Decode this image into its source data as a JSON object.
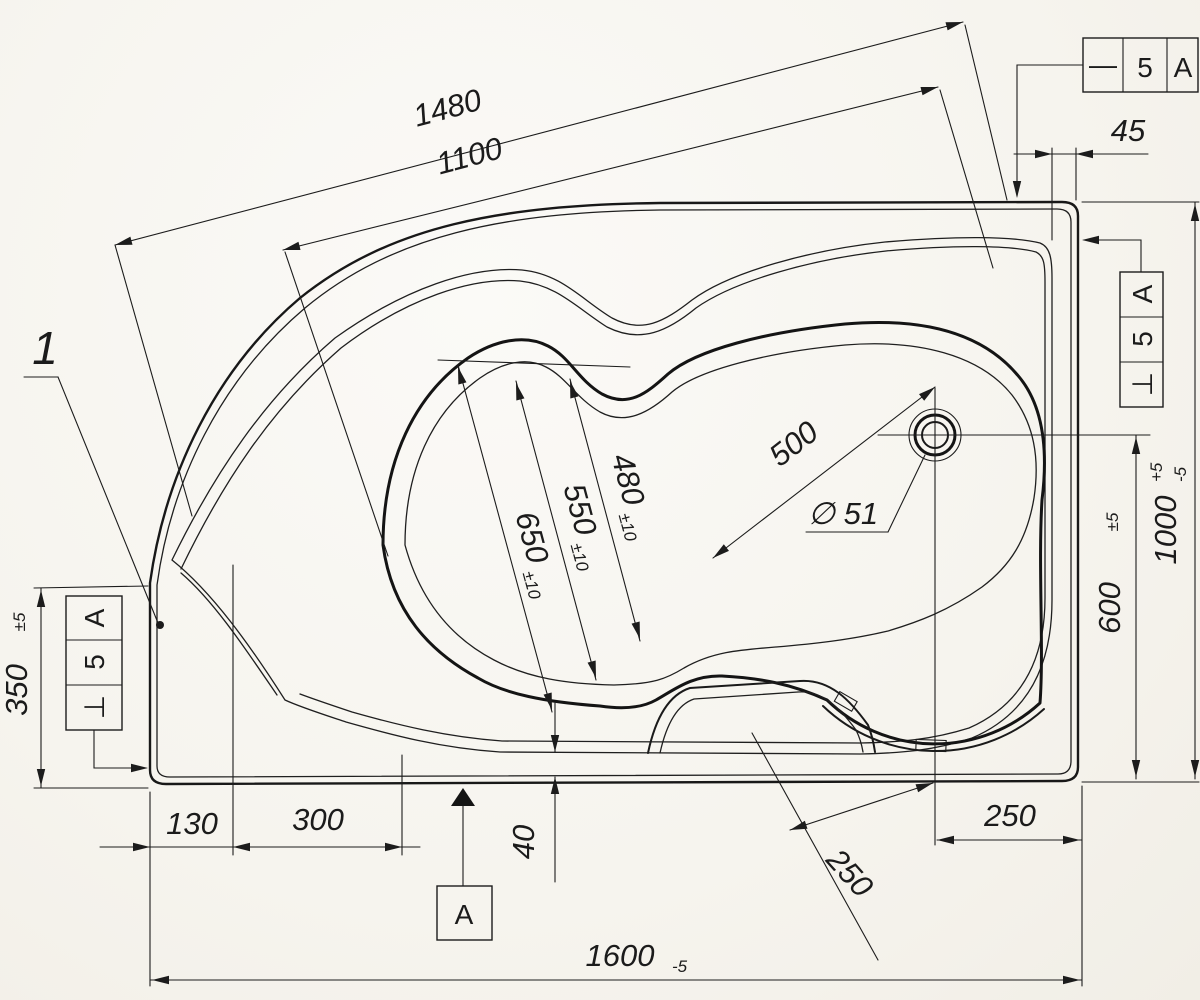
{
  "colors": {
    "ink": "#1c1c1c",
    "paper": "#f7f5f0"
  },
  "labels": {
    "item_number": "1",
    "section_letter": "A",
    "datum_letter": "A",
    "drain_diameter": "∅ 51"
  },
  "dimensions": {
    "diagonal_outer": {
      "value": "1480"
    },
    "diagonal_inner": {
      "value": "1100"
    },
    "rim_width_top": {
      "value": "45"
    },
    "left_edge_height": {
      "value": "350",
      "tol": "±5"
    },
    "bottom_offset_1": {
      "value": "130"
    },
    "bottom_offset_2": {
      "value": "300"
    },
    "rim_width_bottom": {
      "value": "40"
    },
    "overall_length": {
      "value": "1600",
      "tol": "-5"
    },
    "drain_to_bottom": {
      "value": "600",
      "tol": "±5"
    },
    "overall_width": {
      "value": "1000",
      "tol_plus": "+5",
      "tol_minus": "-5"
    },
    "drain_to_right": {
      "value": "250"
    },
    "seat_diagonal": {
      "value": "250"
    },
    "drain_diagonal": {
      "value": "500"
    },
    "basin_width_1": {
      "value": "650",
      "tol": "±10"
    },
    "basin_width_2": {
      "value": "550",
      "tol": "±10"
    },
    "basin_width_3": {
      "value": "480",
      "tol": "±10"
    }
  },
  "feature_frames": {
    "top_right": {
      "symbol": "—",
      "value": "5",
      "datum": "A"
    },
    "right": {
      "symbol": "⊥",
      "value": "5",
      "datum": "A"
    },
    "left": {
      "symbol": "⊥",
      "value": "5",
      "datum": "A"
    }
  }
}
